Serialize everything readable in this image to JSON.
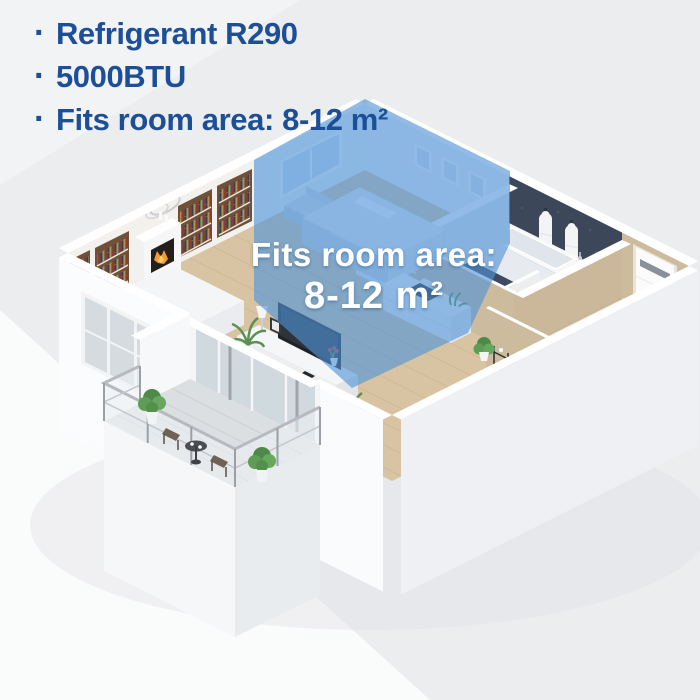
{
  "features": {
    "bullet": "·",
    "items": [
      "Refrigerant R290",
      "5000BTU",
      "Fits room area: 8-12 m²"
    ]
  },
  "floorplan_overlay": {
    "line1": "Fits room area:",
    "line2": "8-12 m²"
  },
  "colors": {
    "headline_text": "#1d4f97",
    "background": "#ebedef",
    "highlight_overlay": "#4f93d8",
    "overlay_text": "#ffffff",
    "wood_floor": "#d8c4a2",
    "bathroom_wall": "#3c4759",
    "hall_wall": "#cdbb9e"
  }
}
